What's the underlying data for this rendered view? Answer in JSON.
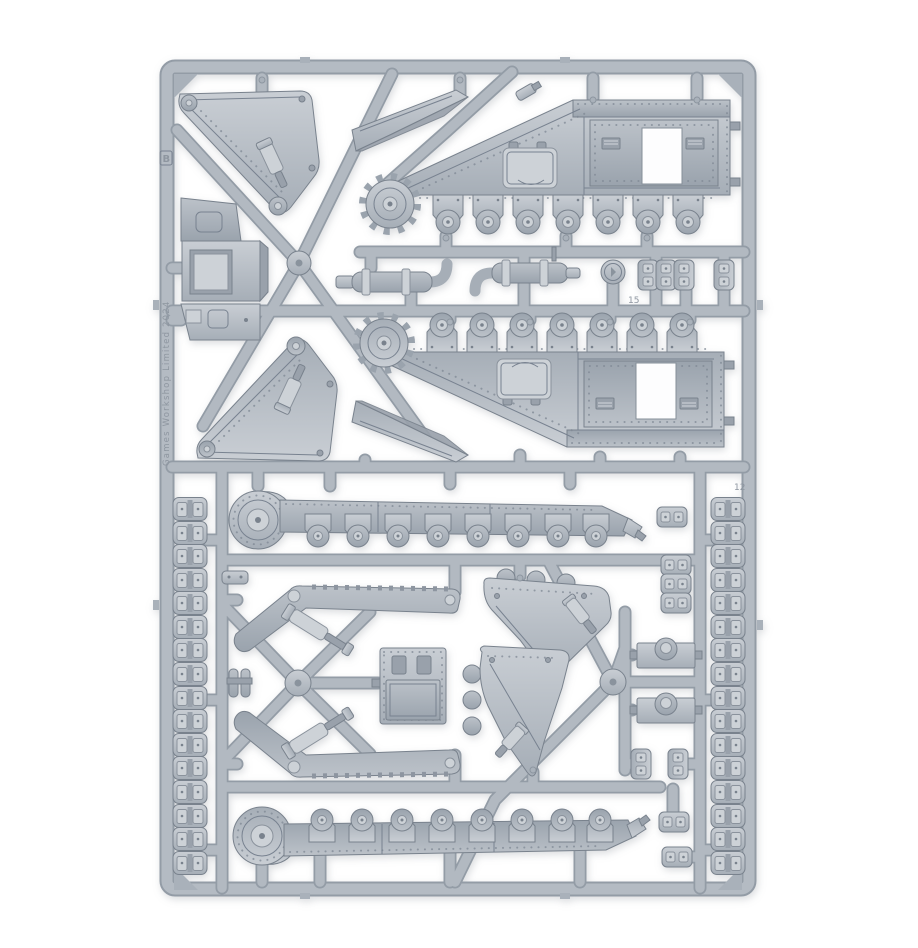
{
  "photo": {
    "subject": "Grey plastic model-kit sprue frame holding tank hull, track and armour components, photographed on a white background",
    "background_color": "#ffffff",
    "plastic_color": "#b6bdc5",
    "plastic_shadow_color": "#8d95a0",
    "plastic_highlight_color": "#d6dade"
  },
  "sprue": {
    "frame_letter": "B",
    "runner_number": "15",
    "frame_number": "12",
    "copyright": "Games Workshop Limited 2024"
  }
}
